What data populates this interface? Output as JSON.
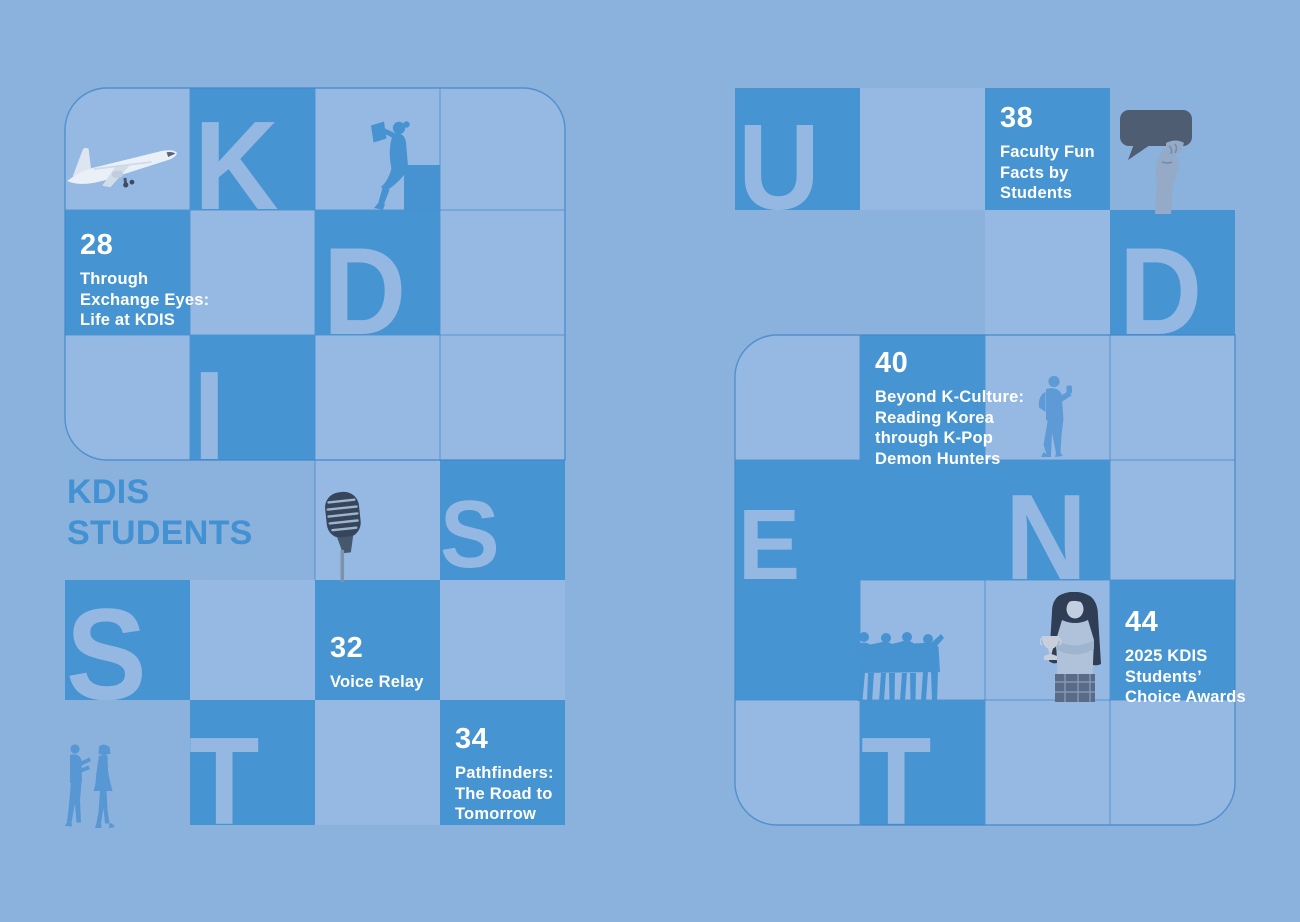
{
  "colors": {
    "background": "#8BB1DD",
    "light_cell": "#96B9E4",
    "dark_cell": "#4794D2",
    "letter": "#95B8E3",
    "grid_line": "#4489CB",
    "title_text": "#4291D3",
    "entry_text": "#FFFFFF",
    "speech_bubble": "#4E5D72"
  },
  "title": {
    "line1": "KDIS",
    "line2": "STUDENTS"
  },
  "grids": {
    "left": {
      "cols": [
        65,
        190,
        315,
        440,
        565
      ],
      "rows": [
        88,
        210,
        335,
        460,
        580,
        700,
        825
      ],
      "dark_cells": [
        [
          1,
          0
        ],
        [
          0,
          1
        ],
        [
          2,
          1
        ],
        [
          1,
          2
        ],
        [
          3,
          3
        ],
        [
          0,
          4
        ],
        [
          2,
          4
        ],
        [
          1,
          5
        ],
        [
          3,
          5
        ]
      ],
      "light_cells": [
        [
          0,
          0
        ],
        [
          2,
          0
        ],
        [
          3,
          0
        ],
        [
          1,
          1
        ],
        [
          3,
          1
        ],
        [
          0,
          2
        ],
        [
          2,
          2
        ],
        [
          3,
          2
        ],
        [
          2,
          3
        ],
        [
          1,
          4
        ],
        [
          3,
          4
        ],
        [
          2,
          5
        ]
      ],
      "outline": {
        "x": 65,
        "y": 88,
        "w": 500,
        "h": 372,
        "r": {
          "tl": 42,
          "tr": 42,
          "bl": 42,
          "br": 0
        }
      },
      "extra_lines": [
        [
          315,
          460,
          315,
          580
        ]
      ],
      "rounded_cells": {
        "0,0": "tl",
        "3,0": "tr",
        "0,2": "bl"
      },
      "letters": [
        {
          "c": 1,
          "r": 0,
          "ch": "K",
          "fs": 126,
          "dx": 4
        },
        {
          "c": 2,
          "r": 1,
          "ch": "D",
          "fs": 124,
          "dx": 8
        },
        {
          "c": 1,
          "r": 2,
          "ch": "I",
          "fs": 126,
          "dx": 3
        },
        {
          "c": 3,
          "r": 3,
          "ch": "S",
          "fs": 96,
          "dx": 0,
          "dy": -12
        },
        {
          "c": 0,
          "r": 4,
          "ch": "S",
          "fs": 130,
          "dx": 1
        },
        {
          "c": 1,
          "r": 5,
          "ch": "T",
          "fs": 124,
          "dx": -1
        }
      ]
    },
    "right": {
      "cols": [
        735,
        860,
        985,
        1110,
        1235
      ],
      "rows": [
        88,
        210,
        335,
        460,
        580,
        700,
        825
      ],
      "dark_cells": [
        [
          0,
          0
        ],
        [
          2,
          0
        ],
        [
          3,
          1
        ],
        [
          1,
          2
        ],
        [
          0,
          3
        ],
        [
          1,
          3
        ],
        [
          2,
          3
        ],
        [
          0,
          4
        ],
        [
          3,
          4
        ],
        [
          1,
          5
        ]
      ],
      "light_cells": [
        [
          1,
          0
        ],
        [
          2,
          1
        ],
        [
          0,
          2
        ],
        [
          2,
          2
        ],
        [
          3,
          2
        ],
        [
          3,
          3
        ],
        [
          1,
          4
        ],
        [
          2,
          4
        ],
        [
          0,
          5
        ],
        [
          2,
          5
        ],
        [
          3,
          5
        ]
      ],
      "outline": {
        "x": 735,
        "y": 335,
        "w": 500,
        "h": 490,
        "r": {
          "tl": 42,
          "tr": 0,
          "bl": 42,
          "br": 42
        }
      },
      "extra_lines": [],
      "rounded_cells": {
        "0,2": "tl",
        "0,5": "bl",
        "3,5": "br"
      },
      "letters": [
        {
          "c": 0,
          "r": 0,
          "ch": "U",
          "fs": 122,
          "dx": 3
        },
        {
          "c": 3,
          "r": 1,
          "ch": "D",
          "fs": 124,
          "dx": 9
        },
        {
          "c": 0,
          "r": 3,
          "ch": "E",
          "fs": 100,
          "dx": 3
        },
        {
          "c": 2,
          "r": 3,
          "ch": "N",
          "fs": 122,
          "dx": 20
        },
        {
          "c": 1,
          "r": 5,
          "ch": "T",
          "fs": 124,
          "dx": 1
        }
      ]
    }
  },
  "entries": [
    {
      "grid": "left",
      "c": 0,
      "r": 1,
      "number": "28",
      "pad": 20,
      "lines": [
        "Through",
        "Exchange Eyes:",
        "Life at KDIS"
      ]
    },
    {
      "grid": "left",
      "c": 2,
      "r": 4,
      "number": "32",
      "pad": 53,
      "lines": [
        "Voice Relay"
      ]
    },
    {
      "grid": "left",
      "c": 3,
      "r": 5,
      "number": "34",
      "pad": 24,
      "lines": [
        "Pathfinders:",
        "The Road to",
        "Tomorrow"
      ]
    },
    {
      "grid": "right",
      "c": 2,
      "r": 0,
      "number": "38",
      "pad": 15,
      "lines": [
        "Faculty Fun",
        "Facts by",
        "Students"
      ]
    },
    {
      "grid": "right",
      "c": 1,
      "r": 2,
      "number": "40",
      "pad": 13,
      "lines": [
        "Beyond K-Culture:",
        "Reading Korea",
        "through K-Pop",
        "Demon Hunters"
      ]
    },
    {
      "grid": "right",
      "c": 3,
      "r": 4,
      "number": "44",
      "pad": 27,
      "lines": [
        "2025 KDIS",
        "Students’",
        "Choice Awards"
      ]
    }
  ],
  "figures": [
    "airplane-photo",
    "reading-person-silhouette",
    "vintage-microphone-photo",
    "two-people-talking-silhouette",
    "speech-bubble-in-hand-photo",
    "standing-student-silhouette",
    "group-of-friends-silhouette",
    "girl-with-trophy-photo"
  ]
}
